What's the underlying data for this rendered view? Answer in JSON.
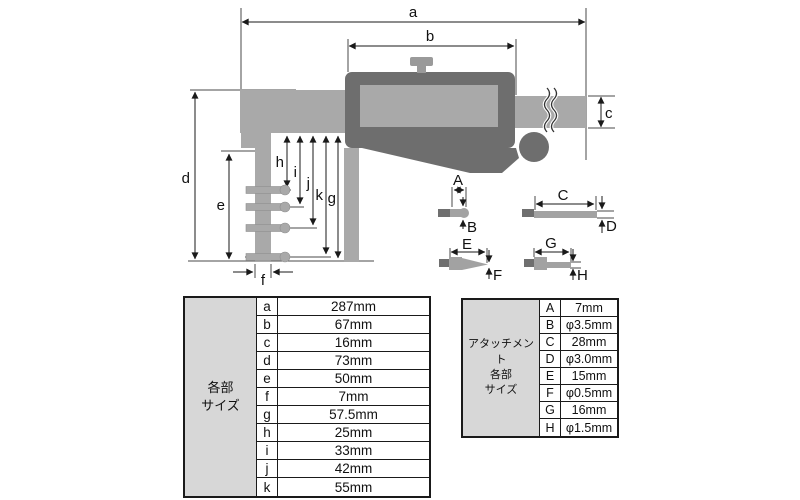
{
  "colors": {
    "background": "#ffffff",
    "light_gray_metal": "#a9a9a9",
    "dark_gray_body": "#6e6e6e",
    "table_header_bg": "#d7d7d7",
    "line": "#1a1a1a"
  },
  "diagram": {
    "part_dims": {
      "a": "a",
      "b": "b",
      "c": "c",
      "d": "d",
      "e": "e",
      "f": "f",
      "g": "g",
      "h": "h",
      "i": "i",
      "j": "j",
      "k": "k"
    },
    "attachment_dims": {
      "A": "A",
      "B": "B",
      "C": "C",
      "D": "D",
      "E": "E",
      "F": "F",
      "G": "G",
      "H": "H"
    }
  },
  "size_table": {
    "header_lines": [
      "各部",
      "サイズ"
    ],
    "rows": [
      {
        "key": "a",
        "value": "287mm"
      },
      {
        "key": "b",
        "value": "67mm"
      },
      {
        "key": "c",
        "value": "16mm"
      },
      {
        "key": "d",
        "value": "73mm"
      },
      {
        "key": "e",
        "value": "50mm"
      },
      {
        "key": "f",
        "value": "7mm"
      },
      {
        "key": "g",
        "value": "57.5mm"
      },
      {
        "key": "h",
        "value": "25mm"
      },
      {
        "key": "i",
        "value": "33mm"
      },
      {
        "key": "j",
        "value": "42mm"
      },
      {
        "key": "k",
        "value": "55mm"
      }
    ]
  },
  "attachment_table": {
    "header_lines": [
      "アタッチメント",
      "各部",
      "サイズ"
    ],
    "rows": [
      {
        "key": "A",
        "value": "7mm"
      },
      {
        "key": "B",
        "value": "φ3.5mm"
      },
      {
        "key": "C",
        "value": "28mm"
      },
      {
        "key": "D",
        "value": "φ3.0mm"
      },
      {
        "key": "E",
        "value": "15mm"
      },
      {
        "key": "F",
        "value": "φ0.5mm"
      },
      {
        "key": "G",
        "value": "16mm"
      },
      {
        "key": "H",
        "value": "φ1.5mm"
      }
    ]
  }
}
